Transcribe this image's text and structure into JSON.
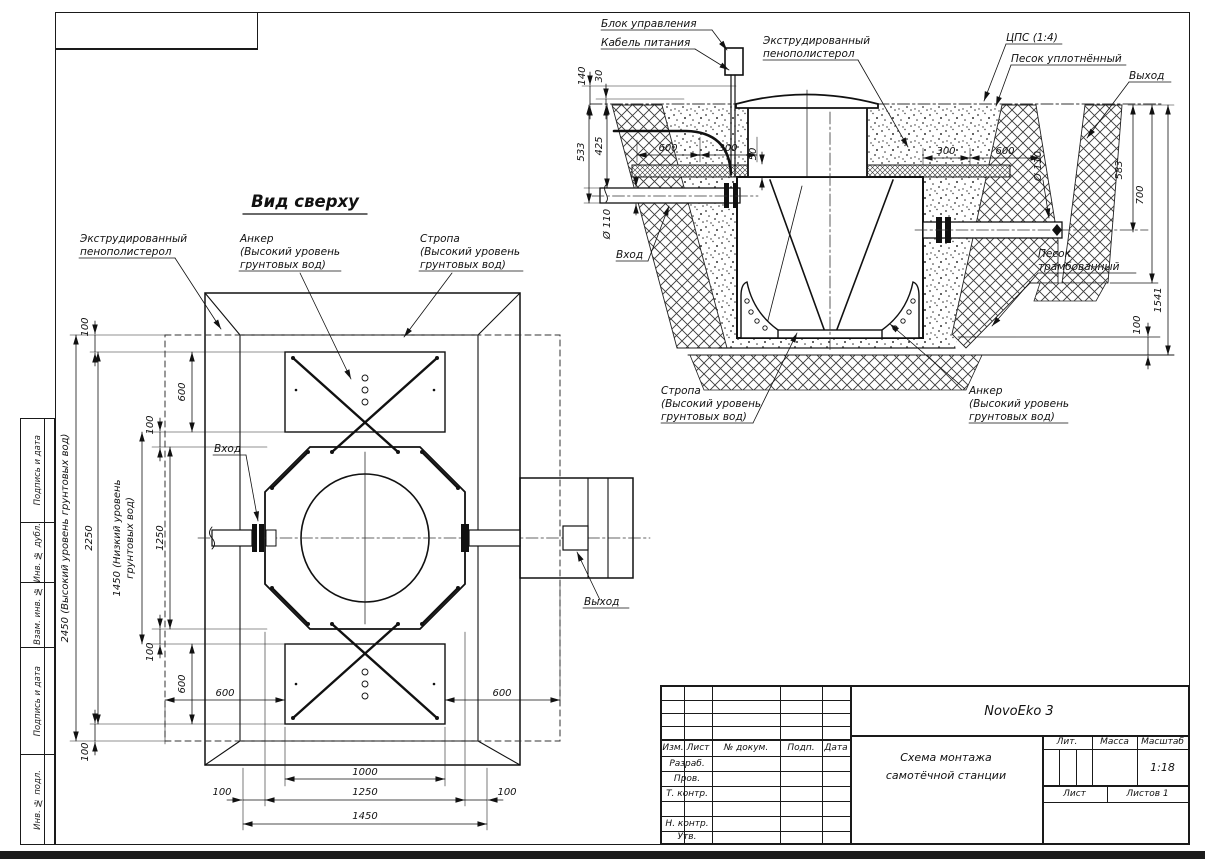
{
  "side_column": {
    "cells": [
      "Подпись и дата",
      "Инв. № дубл.",
      "Взам. инв. №",
      "Подпись и дата",
      "Инв. № подл."
    ]
  },
  "title_block": {
    "product": "NovoEko 3",
    "title_line1": "Схема монтажа",
    "title_line2": "самотёчной станции",
    "col_izm": "Изм.",
    "col_list": "Лист",
    "col_doc": "№ докум.",
    "col_podp": "Подп.",
    "col_data": "Дата",
    "row_razrab": "Разраб.",
    "row_prov": "Пров.",
    "row_tkontr": "Т. контр.",
    "row_nkontr": "Н. контр.",
    "row_utv": "Утв.",
    "lit": "Лит.",
    "massa": "Масса",
    "masshtab": "Масштаб",
    "scale": "1:18",
    "sheet": "Лист",
    "sheets": "Листов 1"
  },
  "section": {
    "labels": {
      "control_unit": "Блок управления",
      "power_cable": "Кабель питания",
      "eps1": "Экструдированный",
      "eps2": "пенополистерол",
      "cps": "ЦПС (1:4)",
      "sand_compacted": "Песок уплотнённый",
      "outlet": "Выход",
      "inlet": "Вход",
      "sand1": "Песок",
      "sand2": "трамбованный",
      "sling1": "Стропа",
      "sling2": "(Высокий уровень",
      "sling3": "грунтовых вод)",
      "anchor1": "Анкер",
      "anchor2": "(Высокий уровень",
      "anchor3": "грунтовых вод)"
    },
    "dims": {
      "h140": "140",
      "h30": "30",
      "h533": "533",
      "h425": "425",
      "w600l": "600",
      "w300l": "300",
      "g50": "50",
      "w300r": "300",
      "w600r": "600",
      "dia_in": "Ø 110",
      "dia_out": "Ø 110",
      "h583": "583",
      "h700": "700",
      "h1541": "1541",
      "t100": "100"
    }
  },
  "top_view": {
    "title": "Вид сверху",
    "labels": {
      "eps1": "Экструдированный",
      "eps2": "пенополистерол",
      "anchor1": "Анкер",
      "anchor2": "(Высокий уровень",
      "anchor3": "грунтовых вод)",
      "sling1": "Стропа",
      "sling2": "(Высокий уровень",
      "sling3": "грунтовых вод)",
      "inlet": "Вход",
      "outlet": "Выход"
    },
    "dims": {
      "v100_top": "100",
      "v600_top": "600",
      "v100_mid_top": "100",
      "v1250": "1250",
      "v1450a": "1450 (Низкий уровень",
      "v1450b": "грунтовых вод)",
      "v2250": "2250",
      "v2450": "2450 (Высокий уровень грунтовых вод)",
      "v100_mid_bot": "100",
      "v600_bot": "600",
      "v100_bot": "100",
      "b600l": "600",
      "b600r": "600",
      "b1000": "1000",
      "b1250": "1250",
      "b100l": "100",
      "b100r": "100",
      "b1450": "1450"
    }
  }
}
